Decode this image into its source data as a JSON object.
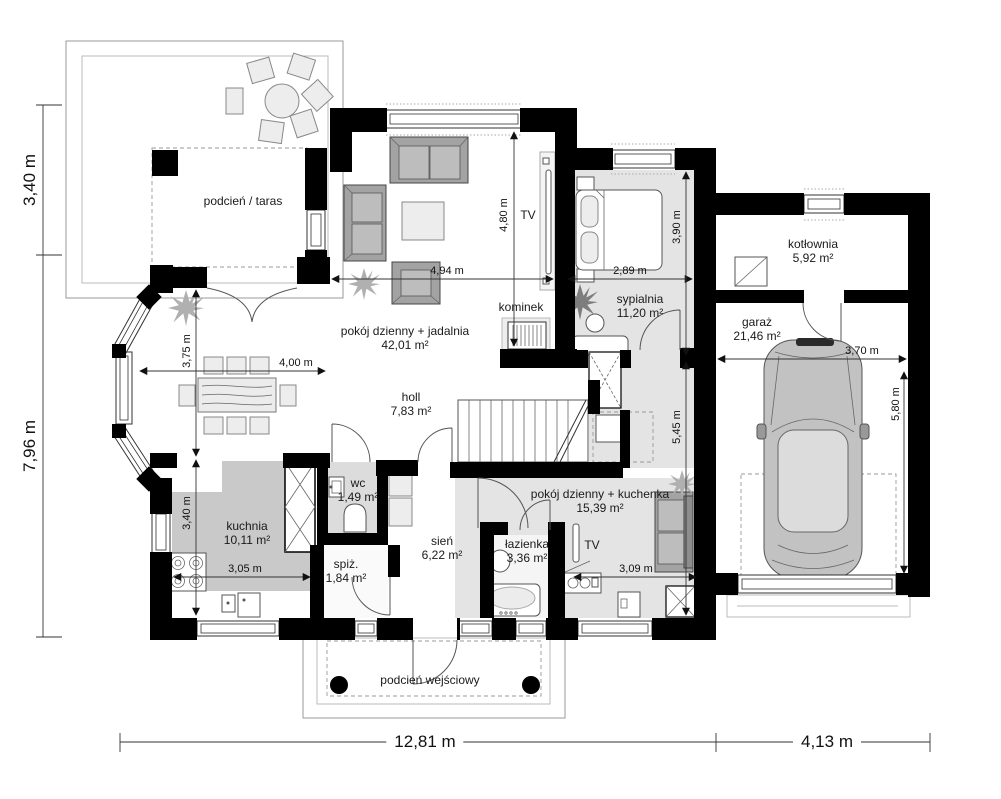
{
  "title": "rzut parteru - plan domu",
  "rooms": {
    "terrace": {
      "name": "podcień / taras"
    },
    "living": {
      "name": "pokój dzienny + jadalnia",
      "area": "42,01 m²"
    },
    "bedroom": {
      "name": "sypialnia",
      "area": "11,20 m²"
    },
    "boiler_room": {
      "name": "kotłownia",
      "area": "5,92 m²"
    },
    "garage": {
      "name": "garaż",
      "area": "21,46 m²"
    },
    "hall": {
      "name": "holl",
      "area": "7,83 m²"
    },
    "wc": {
      "name": "wc",
      "area": "1,49 m²"
    },
    "kitchen": {
      "name": "kuchnia",
      "area": "10,11 m²"
    },
    "pantry": {
      "name": "spiż.",
      "area": "1,84 m²"
    },
    "vestibule": {
      "name": "sień",
      "area": "6,22 m²"
    },
    "bathroom": {
      "name": "łazienka",
      "area": "3,36 m²"
    },
    "guest_room": {
      "name": "pokój dzienny + kuchenka",
      "area": "15,39 m²"
    },
    "entrance_porch": {
      "name": "podcień wejściowy"
    }
  },
  "features": {
    "fireplace": "kominek",
    "tv_living": "TV",
    "tv_guest": "TV"
  },
  "dimensions": {
    "terrace_depth": "3,40 m",
    "house_side": "7,96 m",
    "house_width": "12,81 m",
    "garage_width_overall": "4,13 m",
    "living_width": "4,94 m",
    "living_depth": "4,80 m",
    "bedroom_width": "2,89 m",
    "bedroom_depth": "3,90 m",
    "guest_depth": "5,45 m",
    "dining_depth": "3,75 m",
    "dining_width": "4,00 m",
    "kitchen_depth": "3,40 m",
    "kitchen_width": "3,05 m",
    "guest_width": "3,09 m",
    "garage_inner_width": "3,70 m",
    "garage_inner_depth": "5,80 m"
  },
  "colors": {
    "wall": "#000000",
    "room_fill": "#e4e4e4",
    "kitchen_fill": "#c9c9c9",
    "dimension_line": "#333333"
  }
}
